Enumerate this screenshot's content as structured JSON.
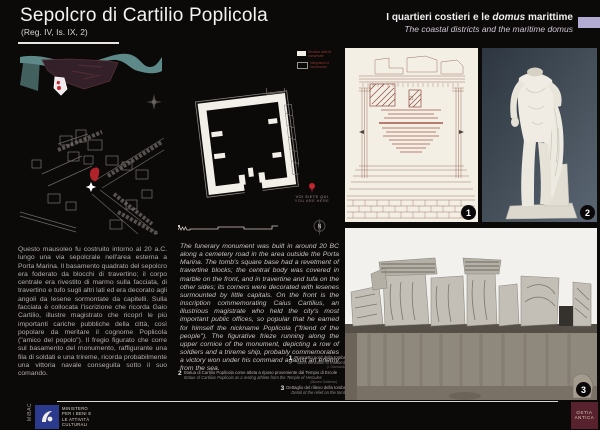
{
  "header": {
    "title": "Sepolcro di Cartilio Poplicola",
    "subtitle": "(Reg. IV, Is. IX, 2)",
    "section_it_prefix": "I quartieri costieri e le ",
    "section_it_domus": "domus",
    "section_it_suffix": " marittime",
    "section_en": "The coastal districts and the maritime domus",
    "accent_color": "#b3abd1"
  },
  "body": {
    "text_it": "Questo mausoleo fu costruito intorno al 20 a.C. lungo una via sepolcrale nell'area esterna a Porta Marina. Il basamento quadrato del sepolcro era foderato da blocchi di travertino; il corpo centrale era rivestito di marmo sulla facciata, di travertino e tufo sugli altri lati ed era decorato agli angoli da lesene sormontate da capitelli. Sulla facciata è collocata l'iscrizione che ricorda Gaio Cartilio, illustre magistrato che ricoprì le più importanti cariche pubbliche della città, così popolare da meritare il cognome Poplicola (\"amico del popolo\"). Il fregio figurato che corre sul basamento del monumento, raffigurante una fila di soldati e una trireme, ricorda probabilmente una vittoria navale conseguita sotto il suo comando.",
    "text_en": "The funerary monument was built in around 20 BC along a cemetery road in the area outside the Porta Marina. The tomb's square base had a revetment of travertine blocks; the central body was covered in marble on the front, and in travertine and tufa on the other sides; its corners were decorated with lesenes surmounted by little capitals. On the front is the inscription commemorating Caius Cartilius, an illustrious magistrate who held the city's most important public offices, so popular that he earned for himself the nickname Poplicola (\"friend of the people\"). The figurative frieze running along the upper cornice of the monument, depicting a row of soldiers and a trireme ship, probably commemorates a victory won under his command against an enemy from the sea."
  },
  "plan": {
    "legend_item1": "Strutture antiche conservate",
    "legend_item2": "Integrazioni e ricostruzioni",
    "you_are_here_it": "VOI SIETE QUI",
    "you_are_here_en": "YOU ARE HERE",
    "compass_label": "N"
  },
  "captions": {
    "fig1": {
      "num": "1",
      "it": "Prospetto nord della tomba",
      "en": "North elevation of the tomb",
      "credit": "(I. Gismondi)"
    },
    "fig2": {
      "num": "2",
      "it": "Statua di Cartilio Poplicola come atleta a riposo proveniente dal Tempio di Ercole",
      "en": "Statue of Cartilius Poplicola as a resting athlete from the Temple of Hercules",
      "credit": "(Museo Ostiense)"
    },
    "fig3": {
      "num": "3",
      "it": "Dettaglio del rilievo della tomba",
      "en": "Detail of the relief on the tomb"
    }
  },
  "badges": {
    "b1": "1",
    "b2": "2",
    "b3": "3"
  },
  "footer": {
    "mibac_vertical": "MiBAC",
    "ministry": [
      "MINISTERO",
      "PER I BENI E",
      "LE ATTIVITÀ",
      "CULTURALI"
    ],
    "ostia": [
      "OSTIA",
      "ANTICA"
    ]
  },
  "colors": {
    "background": "#0c0909",
    "river_teal": "#5d8a88",
    "marker_red": "#c1272d",
    "mibac_blue": "#2b3a8c",
    "ostia_maroon": "#57222e"
  }
}
